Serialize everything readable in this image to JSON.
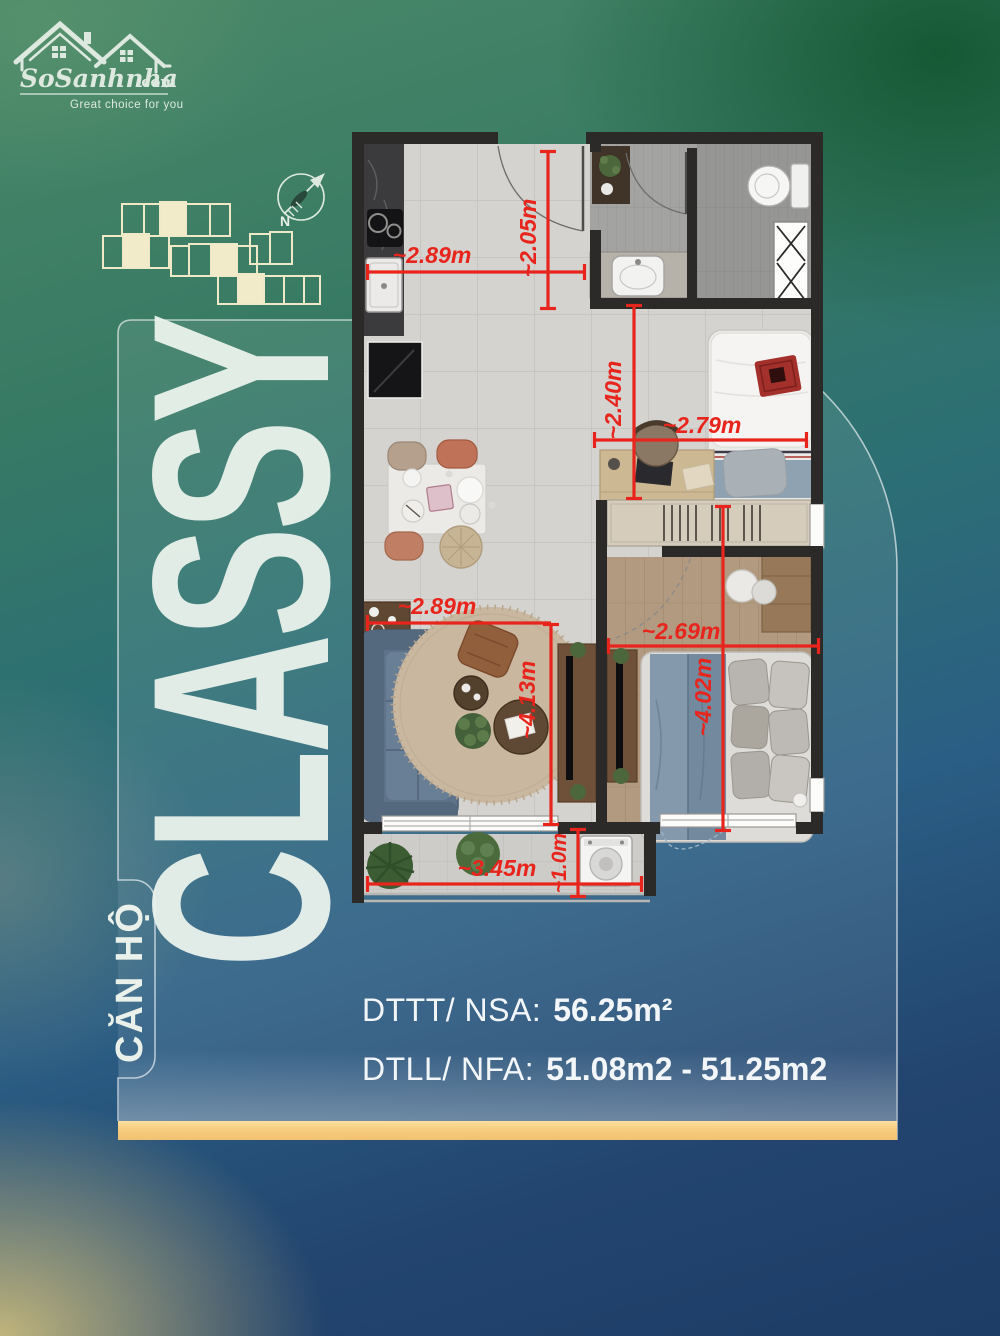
{
  "brand": {
    "name_main": "SoSanhnha",
    "name_suffix": ".com",
    "tagline": "Great choice for you"
  },
  "compass": {
    "north_label": "N"
  },
  "title": {
    "category": "CĂN HỘ",
    "name": "CLASSY"
  },
  "plan": {
    "dims": [
      {
        "label": "~2.05m"
      },
      {
        "label": "~2.89m"
      },
      {
        "label": "~2.40m"
      },
      {
        "label": "~2.79m"
      },
      {
        "label": "~2.89m"
      },
      {
        "label": "~2.69m"
      },
      {
        "label": "~4.13m"
      },
      {
        "label": "~4.02m"
      },
      {
        "label": "~3.45m"
      },
      {
        "label": "~1.0m"
      }
    ]
  },
  "areas": {
    "row1_label": "DTTT/ NSA:",
    "row1_value": "56.25m²",
    "row2_label": "DTLL/ NFA:",
    "row2_value": "51.08m2 - 51.25m2"
  },
  "colors": {
    "dimension_red": "#e8251c",
    "accent_gold": "#f7cc7d",
    "panel_line": "rgba(255,255,255,0.6)",
    "keyplan_cream": "#f0e9c8"
  }
}
